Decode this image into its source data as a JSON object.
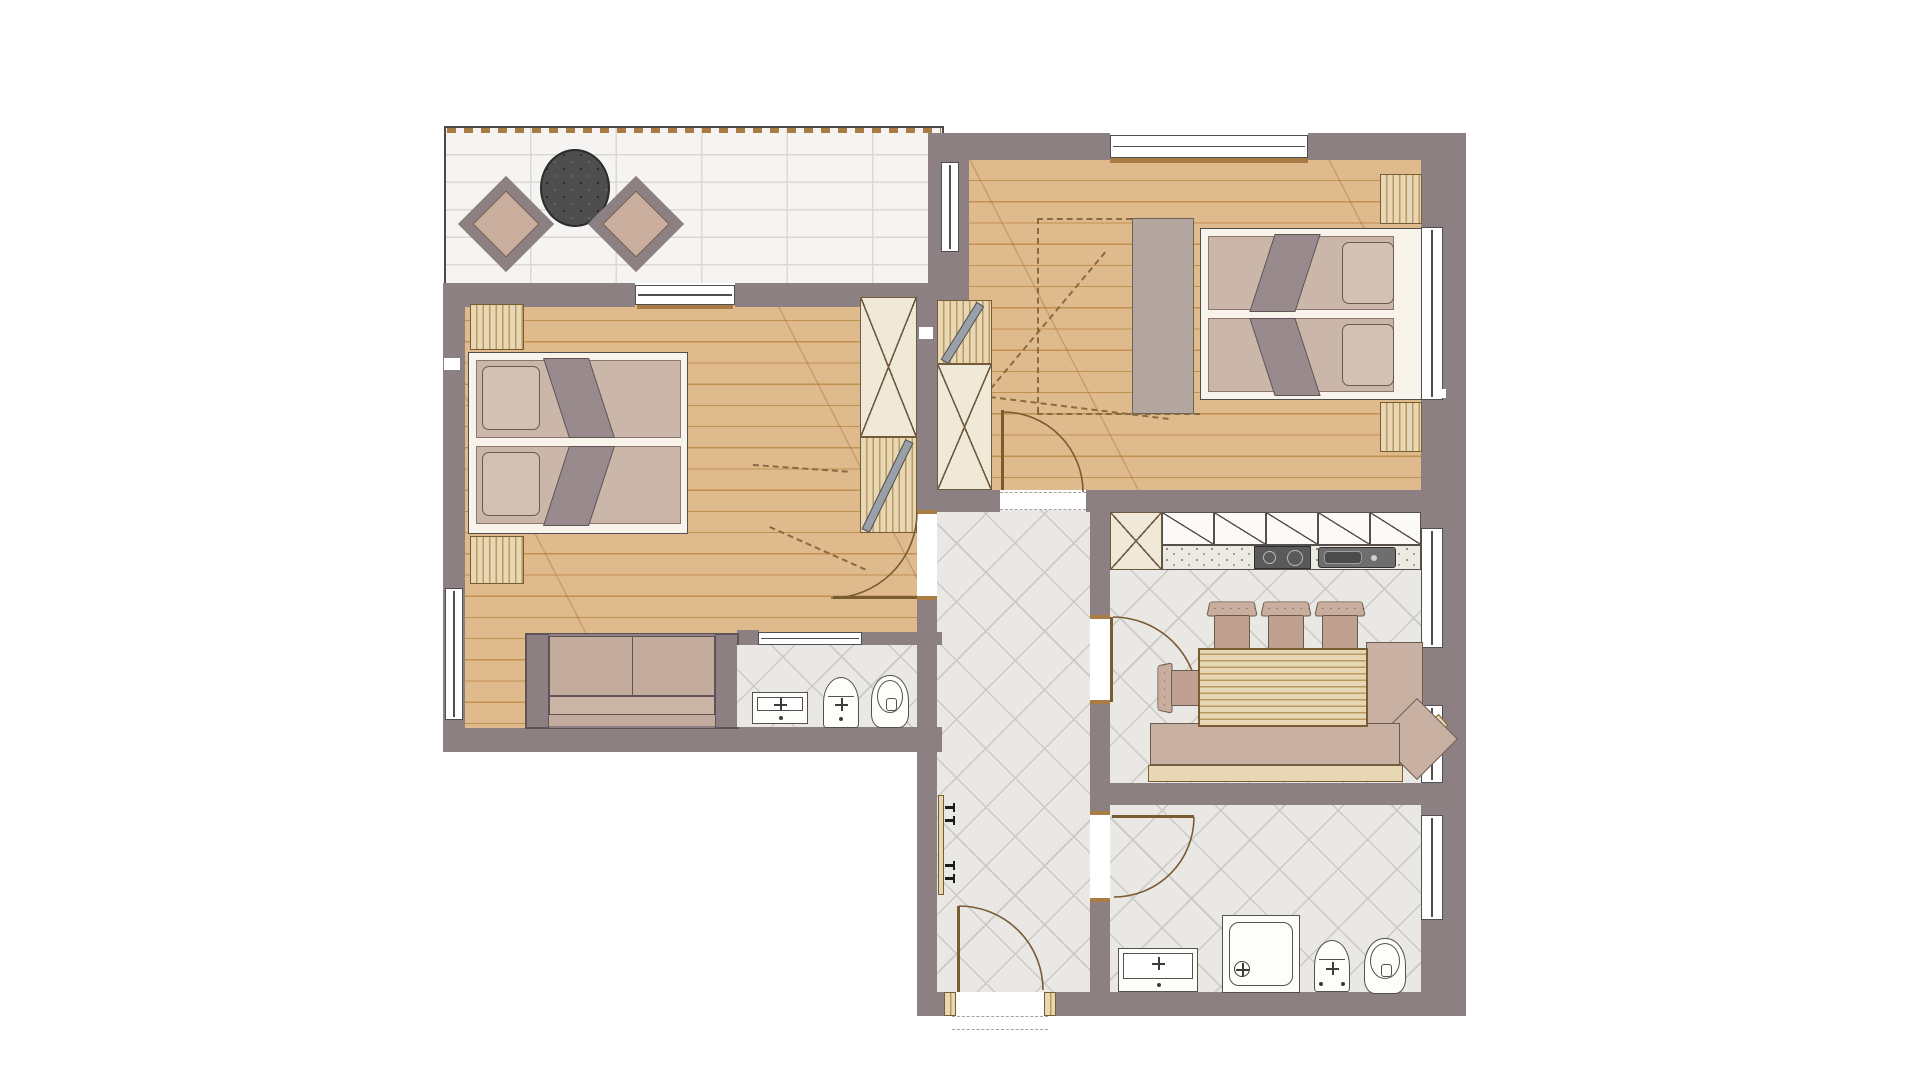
{
  "title": "apartment-floor-plan",
  "plan_type": "architectural top-view floor plan, no text labels",
  "palette": {
    "wall": "#8c8082",
    "wood_floor": "#deba8c",
    "wood_line": "#c1924f",
    "tile_floor": "#e9e8e4",
    "tile_line": "#cbc9c4",
    "terr_tile": "#f5f4f2",
    "terr_line": "#dbd9d4",
    "cream": "#f1e9d8",
    "cream_line": "#6d5a3f",
    "bedframe": "#f8f4ec",
    "mattress": "#cbb7a9",
    "pillow": "#d3c1b3",
    "blanket": "#998b8d",
    "wood_strip": "#e8d7b5",
    "wood_strip_line": "#b9995f",
    "taupe": "#b3a69e",
    "bench": "#c8b1a3",
    "chair_back": "#c9ad9d",
    "chair_seat": "#c0a091",
    "table_dark": "#4e4e4e",
    "counter": "#eceae2",
    "appliance": "#5a5a5a",
    "fixture": "#fdfdfa",
    "dash": "#8a6a3e",
    "frame_wood": "#a97c44"
  },
  "rooms": [
    {
      "id": "terrace",
      "floor": "white-tile",
      "furniture": [
        "round-table",
        "armchair",
        "armchair"
      ]
    },
    {
      "id": "bedroom-left",
      "floor": "wood-plank",
      "furniture": [
        "double-bed",
        "nightstand",
        "nightstand",
        "wardrobe-shelved",
        "wardrobe-open-rail",
        "sofa"
      ]
    },
    {
      "id": "bedroom-right",
      "floor": "wood-plank",
      "furniture": [
        "double-bed",
        "nightstand",
        "nightstand",
        "wardrobe-shelved",
        "wardrobe-open-rail",
        "sideboard"
      ]
    },
    {
      "id": "hallway",
      "floor": "diamond-tile",
      "furniture": [
        "coat-rack",
        "entrance-door"
      ]
    },
    {
      "id": "kitchen-dining",
      "floor": "diamond-tile",
      "furniture": [
        "upper-cabinets",
        "counter",
        "stove",
        "sink",
        "dining-table",
        "chair",
        "chair",
        "chair",
        "chair",
        "corner-bench"
      ]
    },
    {
      "id": "bathroom-small",
      "floor": "diamond-tile",
      "furniture": [
        "washbasin",
        "bidet",
        "toilet"
      ]
    },
    {
      "id": "bathroom-large",
      "floor": "diamond-tile",
      "furniture": [
        "washbasin",
        "shower",
        "bidet",
        "toilet"
      ]
    }
  ],
  "counts": {
    "windows": 8,
    "interior_doors": 4,
    "entrance_doors": 1,
    "dining_chairs": 4
  }
}
